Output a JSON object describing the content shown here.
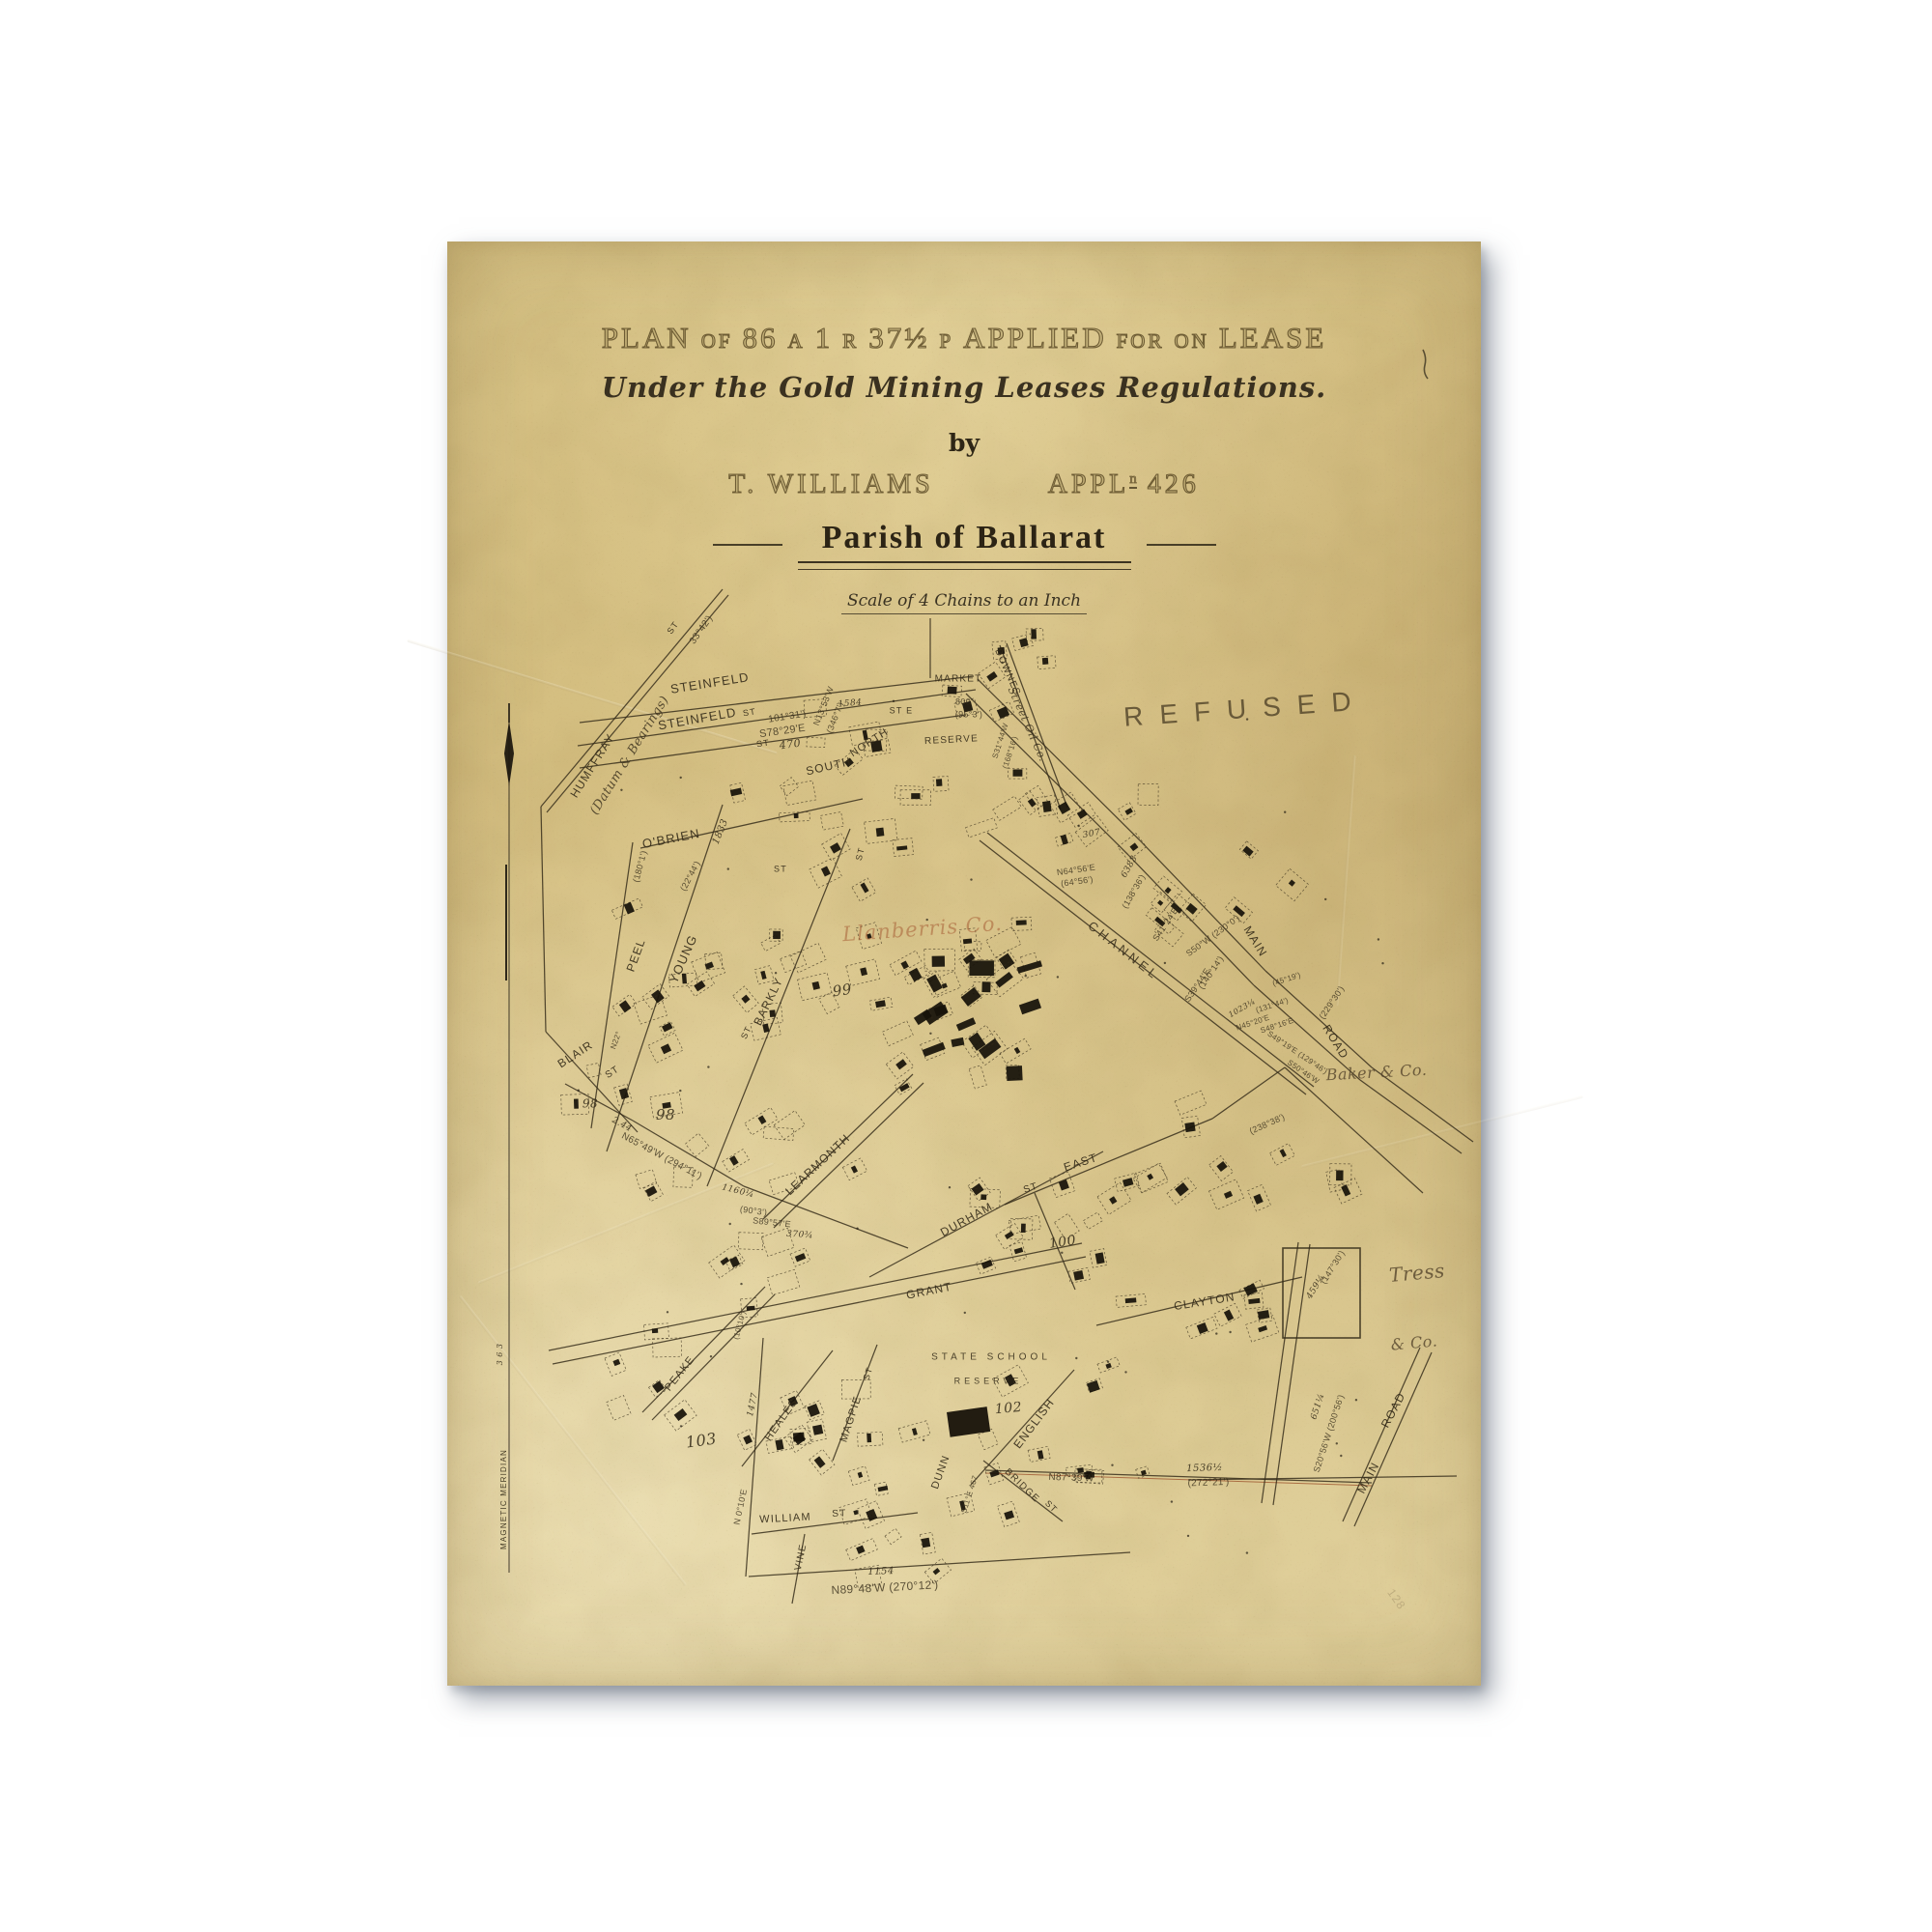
{
  "header": {
    "title_parts": [
      [
        "PLAN",
        1
      ],
      [
        "OF",
        0
      ],
      [
        "86",
        1
      ],
      [
        "A",
        0
      ],
      [
        "1",
        1
      ],
      [
        "R",
        0
      ],
      [
        "37½",
        1
      ],
      [
        "P",
        0
      ],
      [
        "APPLIED",
        1
      ],
      [
        "FOR",
        0
      ],
      [
        "ON",
        0
      ],
      [
        "LEASE",
        1
      ]
    ],
    "subtitle": "Under the Gold Mining Leases Regulations.",
    "by": "by",
    "applicant": "T. WILLIAMS",
    "appl_label": "APPL",
    "appl_sup": "n",
    "appl_number": "426",
    "parish": "Parish of Ballarat",
    "scale": "Scale of 4 Chains to an Inch"
  },
  "stamps": {
    "refused": "REFUSED"
  },
  "map": {
    "ink": "#342b19",
    "red_ink": "#9a4f28",
    "building_ink": "#17120a",
    "labels": [
      [
        "HUMFFRAY",
        151,
        543,
        -58,
        12,
        "st"
      ],
      [
        "(Datum & Bearings)",
        189,
        532,
        -58,
        13,
        "scr2"
      ],
      [
        "ST",
        234,
        400,
        -55,
        9,
        "st"
      ],
      [
        "33°42')",
        263,
        402,
        -55,
        10,
        "b"
      ],
      [
        "STEINFELD",
        272,
        458,
        -9,
        13,
        "st"
      ],
      [
        "ST",
        313,
        488,
        -9,
        9,
        "st"
      ],
      [
        "101°31')",
        352,
        492,
        -9,
        10,
        "b"
      ],
      [
        "STEINFELD",
        259,
        495,
        -10,
        13,
        "st"
      ],
      [
        "S78°29'E",
        347,
        507,
        -8,
        11,
        "b"
      ],
      [
        "ST",
        327,
        520,
        -8,
        9,
        "st"
      ],
      [
        "470",
        355,
        521,
        -8,
        11,
        "n"
      ],
      [
        "SOUTH",
        395,
        544,
        -13,
        12,
        "st"
      ],
      [
        "NORTH",
        437,
        519,
        -33,
        11,
        "st"
      ],
      [
        "N13°53'W",
        390,
        481,
        -68,
        9,
        "b"
      ],
      [
        "(346°7')",
        402,
        493,
        -68,
        9,
        "b"
      ],
      [
        "1584",
        417,
        478,
        -5,
        9,
        "n"
      ],
      [
        "ST E",
        470,
        486,
        0,
        9,
        "st"
      ],
      [
        "MARKET",
        529,
        453,
        0,
        10,
        "st"
      ],
      [
        "800'",
        535,
        477,
        0,
        9,
        "b"
      ],
      [
        "(95°3')",
        540,
        490,
        0,
        9,
        "b"
      ],
      [
        "RESERVE",
        522,
        516,
        -3,
        10,
        "st"
      ],
      [
        "DOWNES",
        580,
        446,
        66,
        10,
        "st"
      ],
      [
        "Street Oil Co.",
        600,
        500,
        66,
        11,
        "scr2"
      ],
      [
        "S31°44'W",
        573,
        517,
        -72,
        8,
        "b"
      ],
      [
        "(168°16')",
        583,
        529,
        -72,
        8,
        "b"
      ],
      [
        "O'BRIEN",
        232,
        619,
        -11,
        13,
        "st"
      ],
      [
        "1833",
        283,
        611,
        -68,
        10,
        "n"
      ],
      [
        "(22°44')",
        252,
        657,
        -62,
        9,
        "b"
      ],
      [
        "(180°1')",
        200,
        647,
        -75,
        9,
        "b"
      ],
      [
        "ST",
        345,
        650,
        0,
        9,
        "st"
      ],
      [
        "PEEL",
        196,
        739,
        -70,
        12,
        "st"
      ],
      [
        "YOUNG",
        245,
        743,
        -66,
        13,
        "st"
      ],
      [
        "BARKLY",
        333,
        787,
        -64,
        12,
        "st"
      ],
      [
        "ST",
        310,
        819,
        -64,
        9,
        "st"
      ],
      [
        "ST",
        428,
        634,
        -75,
        9,
        "st"
      ],
      [
        "99",
        409,
        776,
        -8,
        15,
        "n"
      ],
      [
        "Llanberris Co.",
        492,
        713,
        -4,
        21,
        "red"
      ],
      [
        "CHANNEL",
        700,
        735,
        38,
        13,
        "st2"
      ],
      [
        "307",
        667,
        613,
        -10,
        9,
        "n"
      ],
      [
        "N64°56'E",
        651,
        651,
        -8,
        9,
        "b"
      ],
      [
        "(64°56')",
        652,
        663,
        -8,
        9,
        "b"
      ],
      [
        "6383",
        706,
        647,
        -60,
        9,
        "n"
      ],
      [
        "(138°36')",
        711,
        673,
        -60,
        9,
        "b"
      ],
      [
        "S41°24'E",
        744,
        707,
        -56,
        9,
        "b"
      ],
      [
        "S50°W (230°0')",
        793,
        719,
        -36,
        9,
        "b"
      ],
      [
        "MAIN",
        836,
        725,
        58,
        12,
        "st"
      ],
      [
        "(140°14')",
        791,
        757,
        -56,
        9,
        "b"
      ],
      [
        "S39°44'E",
        777,
        770,
        -56,
        9,
        "b"
      ],
      [
        "1023¼",
        823,
        794,
        -30,
        8,
        "n"
      ],
      [
        "N45°20'E",
        834,
        809,
        -18,
        8,
        "b"
      ],
      [
        "(45°19')",
        869,
        764,
        -18,
        8,
        "b"
      ],
      [
        "(131°44')",
        854,
        791,
        -18,
        8,
        "b"
      ],
      [
        "S48°16'E",
        859,
        812,
        -18,
        8,
        "b"
      ],
      [
        "(229°30')",
        916,
        788,
        -56,
        9,
        "b"
      ],
      [
        "ROAD",
        919,
        829,
        58,
        12,
        "st"
      ],
      [
        "S49°19'E (129°46')",
        880,
        840,
        34,
        8,
        "b"
      ],
      [
        "S50°46'W",
        886,
        860,
        34,
        8,
        "b"
      ],
      [
        "(238°38')",
        849,
        914,
        -24,
        9,
        "b"
      ],
      [
        "Baker & Co.",
        962,
        861,
        -3,
        16,
        "scr"
      ],
      [
        "BLAIR",
        133,
        842,
        -33,
        12,
        "st"
      ],
      [
        "ST",
        171,
        860,
        -33,
        10,
        "st"
      ],
      [
        "98",
        148,
        893,
        0,
        12,
        "n"
      ],
      [
        "98",
        226,
        905,
        0,
        15,
        "n"
      ],
      [
        "2.44",
        181,
        914,
        28,
        9,
        "n"
      ],
      [
        "N65°49'W (294°11')",
        222,
        947,
        28,
        10,
        "b"
      ],
      [
        "N22°",
        175,
        827,
        -70,
        8,
        "b"
      ],
      [
        "LEARMONTH",
        384,
        956,
        -43,
        12,
        "st"
      ],
      [
        "1160¼",
        301,
        983,
        14,
        9,
        "n"
      ],
      [
        "(90°3')",
        317,
        1004,
        8,
        9,
        "b"
      ],
      [
        "S89°57'E",
        336,
        1016,
        6,
        9,
        "b"
      ],
      [
        "370¾",
        365,
        1028,
        4,
        9,
        "n"
      ],
      [
        "DURHAM",
        538,
        1013,
        -29,
        12,
        "st"
      ],
      [
        "EAST",
        656,
        954,
        -18,
        12,
        "st"
      ],
      [
        "ST",
        604,
        980,
        -18,
        10,
        "st"
      ],
      [
        "100",
        637,
        1036,
        -8,
        14,
        "n"
      ],
      [
        "GRANT",
        499,
        1087,
        -11,
        12,
        "st"
      ],
      [
        "STATE SCHOOL",
        563,
        1155,
        0,
        10,
        "st2"
      ],
      [
        "RESERVE",
        560,
        1180,
        0,
        9,
        "st2"
      ],
      [
        "102",
        581,
        1208,
        -5,
        14,
        "n"
      ],
      [
        "ENGLISH",
        608,
        1224,
        -53,
        12,
        "st"
      ],
      [
        "DUNN",
        511,
        1274,
        -70,
        11,
        "st"
      ],
      [
        "CLAYTON",
        784,
        1098,
        -9,
        12,
        "st"
      ],
      [
        "BRIDGE",
        595,
        1288,
        44,
        10,
        "st"
      ],
      [
        "ST",
        625,
        1310,
        44,
        9,
        "st"
      ],
      [
        "N87°39'W",
        646,
        1280,
        2,
        10,
        "b"
      ],
      [
        "1536½",
        784,
        1270,
        -2,
        10,
        "n"
      ],
      [
        "(272°21')",
        788,
        1285,
        -2,
        10,
        "b"
      ],
      [
        "S11°E 467",
        541,
        1297,
        -72,
        8,
        "b"
      ],
      [
        "Tress",
        1004,
        1069,
        -5,
        20,
        "scr"
      ],
      [
        "& Co.",
        1001,
        1141,
        -5,
        16,
        "scr"
      ],
      [
        "651¼",
        901,
        1206,
        -72,
        9,
        "n"
      ],
      [
        "S20°56'W (200°56')",
        913,
        1234,
        -72,
        9,
        "b"
      ],
      [
        "(147°30')",
        917,
        1062,
        -58,
        9,
        "b"
      ],
      [
        "459¼",
        899,
        1082,
        -58,
        9,
        "n"
      ],
      [
        "MAIN",
        954,
        1280,
        -62,
        12,
        "st"
      ],
      [
        "ROAD",
        980,
        1210,
        -62,
        12,
        "st"
      ],
      [
        "103",
        263,
        1242,
        -8,
        16,
        "n"
      ],
      [
        "PEAKE",
        241,
        1172,
        -52,
        11,
        "st"
      ],
      [
        "(10°10')",
        303,
        1122,
        -75,
        8,
        "b"
      ],
      [
        "HEALES",
        346,
        1220,
        -55,
        11,
        "st"
      ],
      [
        "MAGPIE",
        418,
        1219,
        -72,
        11,
        "st"
      ],
      [
        "ST",
        436,
        1172,
        -72,
        9,
        "st"
      ],
      [
        "WILLIAM",
        350,
        1322,
        -3,
        11,
        "st"
      ],
      [
        "ST",
        406,
        1317,
        -3,
        10,
        "st"
      ],
      [
        "VINE",
        366,
        1362,
        -78,
        10,
        "st"
      ],
      [
        "N 0°10'E",
        304,
        1310,
        -78,
        9,
        "b"
      ],
      [
        "1477",
        316,
        1204,
        -78,
        9,
        "n"
      ],
      [
        "1154",
        449,
        1377,
        -2,
        10,
        "n"
      ],
      [
        "N89°48'W (270°12')",
        453,
        1394,
        -3,
        12,
        "b"
      ],
      [
        "MAGNETIC MERIDIAN",
        59,
        1302,
        -90,
        8,
        "st"
      ],
      [
        "3 6 3",
        55,
        1152,
        -90,
        8,
        "n"
      ],
      [
        "128",
        982,
        1406,
        55,
        12,
        "pencil"
      ]
    ],
    "roads": [
      [
        285,
        360,
        97,
        585
      ],
      [
        291,
        366,
        103,
        591
      ],
      [
        137,
        498,
        545,
        450
      ],
      [
        135,
        522,
        547,
        464
      ],
      [
        137,
        545,
        537,
        490
      ],
      [
        500,
        390,
        500,
        452
      ],
      [
        572,
        418,
        635,
        588
      ],
      [
        579,
        416,
        642,
        586
      ],
      [
        549,
        453,
        717,
        620
      ],
      [
        717,
        620,
        847,
        755
      ],
      [
        847,
        755,
        957,
        855
      ],
      [
        957,
        855,
        1062,
        932
      ],
      [
        537,
        468,
        705,
        635
      ],
      [
        705,
        635,
        835,
        770
      ],
      [
        835,
        770,
        945,
        868
      ],
      [
        945,
        868,
        1050,
        944
      ],
      [
        559,
        612,
        897,
        875
      ],
      [
        551,
        620,
        889,
        883
      ],
      [
        200,
        628,
        430,
        577
      ],
      [
        192,
        622,
        149,
        918
      ],
      [
        285,
        583,
        165,
        942
      ],
      [
        417,
        608,
        269,
        978
      ],
      [
        102,
        818,
        197,
        922
      ],
      [
        97,
        585,
        102,
        818
      ],
      [
        122,
        872,
        192,
        910
      ],
      [
        192,
        910,
        307,
        978
      ],
      [
        307,
        978,
        477,
        1042
      ],
      [
        327,
        1012,
        482,
        862
      ],
      [
        338,
        1021,
        493,
        871
      ],
      [
        105,
        1148,
        657,
        1037
      ],
      [
        109,
        1162,
        661,
        1051
      ],
      [
        437,
        1072,
        679,
        942
      ],
      [
        577,
        997,
        792,
        908
      ],
      [
        792,
        908,
        867,
        855
      ],
      [
        867,
        855,
        1010,
        985
      ],
      [
        608,
        985,
        650,
        1085
      ],
      [
        542,
        1287,
        649,
        1168
      ],
      [
        555,
        1262,
        637,
        1325
      ],
      [
        312,
        1382,
        707,
        1357
      ],
      [
        557,
        1272,
        957,
        1285
      ],
      [
        557,
        1275,
        957,
        1288,
        "r"
      ],
      [
        309,
        1382,
        327,
        1135
      ],
      [
        315,
        1338,
        487,
        1316
      ],
      [
        370,
        1338,
        357,
        1410
      ],
      [
        305,
        1268,
        399,
        1148
      ],
      [
        399,
        1262,
        445,
        1142
      ],
      [
        202,
        1212,
        329,
        1082
      ],
      [
        212,
        1220,
        339,
        1090
      ],
      [
        672,
        1122,
        885,
        1072
      ],
      [
        893,
        1038,
        855,
        1308
      ],
      [
        881,
        1036,
        843,
        1306
      ],
      [
        767,
        1282,
        1045,
        1278
      ],
      [
        927,
        1325,
        1007,
        1145
      ],
      [
        939,
        1330,
        1019,
        1150
      ]
    ],
    "clusters": [
      [
        300,
        560,
        230,
        95,
        12,
        0,
        0
      ],
      [
        520,
        442,
        55,
        55,
        4,
        0,
        0
      ],
      [
        180,
        690,
        130,
        190,
        10,
        0,
        0
      ],
      [
        300,
        660,
        185,
        160,
        12,
        0,
        0
      ],
      [
        430,
        700,
        165,
        180,
        13,
        0,
        0
      ],
      [
        477,
        742,
        135,
        125,
        20,
        0,
        1
      ],
      [
        120,
        850,
        135,
        140,
        7,
        0,
        0
      ],
      [
        250,
        900,
        205,
        185,
        13,
        0,
        0
      ],
      [
        480,
        960,
        205,
        125,
        12,
        0,
        0
      ],
      [
        660,
        888,
        175,
        105,
        9,
        0,
        0
      ],
      [
        700,
        628,
        175,
        95,
        9,
        40,
        0
      ],
      [
        170,
        1090,
        145,
        170,
        8,
        0,
        0
      ],
      [
        320,
        1150,
        185,
        215,
        13,
        0,
        0
      ],
      [
        520,
        1150,
        205,
        170,
        12,
        0,
        0
      ],
      [
        700,
        1080,
        165,
        100,
        7,
        0,
        0
      ],
      [
        420,
        1290,
        125,
        95,
        6,
        0,
        0
      ],
      [
        560,
        388,
        75,
        55,
        4,
        0,
        0
      ],
      [
        640,
        555,
        95,
        75,
        6,
        0,
        0
      ],
      [
        840,
        925,
        95,
        85,
        5,
        0,
        0
      ],
      [
        360,
        480,
        120,
        60,
        6,
        0,
        0
      ],
      [
        540,
        540,
        120,
        80,
        7,
        0,
        0
      ]
    ],
    "shaft_dot_count": 44,
    "tress_rect": [
      865,
      1042,
      80,
      93
    ],
    "school_block": [
      517,
      1212,
      42,
      26
    ]
  }
}
